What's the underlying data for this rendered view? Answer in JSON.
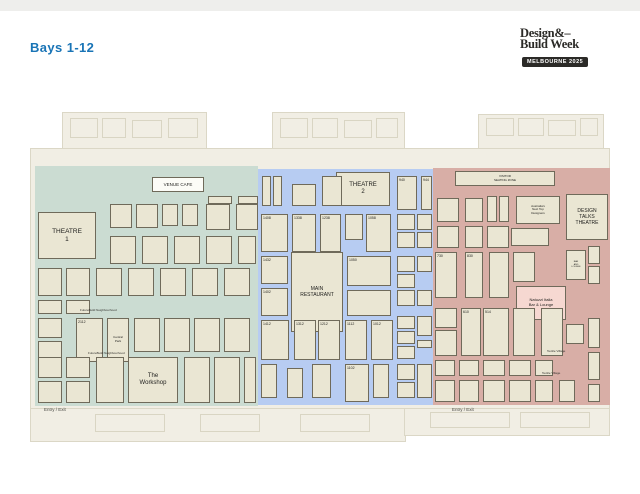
{
  "page": {
    "title": "Bays 1-12"
  },
  "logo": {
    "line1": "Design&–",
    "line2": "Build Week",
    "badge": "MELBOURNE 2025"
  },
  "palette": {
    "accent_blue": "#1974b6",
    "badge_black": "#2b2a27",
    "hall_beige": "#f1eee4",
    "booth_fill": "#eae6d3",
    "booth_border": "#6f6a5a",
    "zone_green": "#cbdcd2",
    "zone_blue": "#b7ccf2",
    "zone_pink": "#d8aea6",
    "highlight_pink": "#f6d8d1"
  },
  "map": {
    "entries": [
      {
        "x": 44,
        "y": 407,
        "label": "Entry / Exit"
      },
      {
        "x": 452,
        "y": 407,
        "label": "Entry / Exit"
      }
    ],
    "zones": [
      {
        "id": "green",
        "color": "#cbdcd2",
        "x": 35,
        "y": 166,
        "w": 223,
        "h": 240,
        "labels": [
          {
            "x": 80,
            "y": 308,
            "text": "FutureBuild Neighbourhood"
          },
          {
            "x": 88,
            "y": 351,
            "text": "FutureBuild Neighbourhood"
          }
        ],
        "booths": [
          {
            "x": 152,
            "y": 177,
            "w": 52,
            "h": 15,
            "label": "VENUE CAFE",
            "type": "banner",
            "fs": 4.5,
            "name": "venue-cafe"
          },
          {
            "x": 38,
            "y": 212,
            "w": 58,
            "h": 47,
            "label": "THEATRE\n1",
            "type": "feature",
            "fs": 6.5,
            "name": "theatre-1"
          },
          {
            "x": 208,
            "y": 196,
            "w": 24,
            "h": 8
          },
          {
            "x": 238,
            "y": 196,
            "w": 20,
            "h": 8
          },
          {
            "x": 110,
            "y": 204,
            "w": 22,
            "h": 24
          },
          {
            "x": 136,
            "y": 204,
            "w": 22,
            "h": 24
          },
          {
            "x": 162,
            "y": 204,
            "w": 16,
            "h": 22
          },
          {
            "x": 182,
            "y": 204,
            "w": 16,
            "h": 22
          },
          {
            "x": 206,
            "y": 204,
            "w": 24,
            "h": 26
          },
          {
            "x": 236,
            "y": 204,
            "w": 22,
            "h": 26
          },
          {
            "x": 110,
            "y": 236,
            "w": 26,
            "h": 28
          },
          {
            "x": 142,
            "y": 236,
            "w": 26,
            "h": 28
          },
          {
            "x": 174,
            "y": 236,
            "w": 26,
            "h": 28
          },
          {
            "x": 206,
            "y": 236,
            "w": 26,
            "h": 28
          },
          {
            "x": 238,
            "y": 236,
            "w": 18,
            "h": 28
          },
          {
            "x": 38,
            "y": 268,
            "w": 24,
            "h": 28
          },
          {
            "x": 66,
            "y": 268,
            "w": 24,
            "h": 28
          },
          {
            "x": 96,
            "y": 268,
            "w": 26,
            "h": 28
          },
          {
            "x": 128,
            "y": 268,
            "w": 26,
            "h": 28
          },
          {
            "x": 160,
            "y": 268,
            "w": 26,
            "h": 28
          },
          {
            "x": 192,
            "y": 268,
            "w": 26,
            "h": 28
          },
          {
            "x": 224,
            "y": 268,
            "w": 26,
            "h": 28
          },
          {
            "x": 38,
            "y": 300,
            "w": 24,
            "h": 14
          },
          {
            "x": 66,
            "y": 300,
            "w": 24,
            "h": 14
          },
          {
            "x": 76,
            "y": 318,
            "w": 27,
            "h": 44,
            "label": "2112",
            "name": "booth-2112"
          },
          {
            "x": 107,
            "y": 318,
            "w": 22,
            "h": 44,
            "label": "Central\nPark",
            "fs": 3,
            "name": "booth-central-park"
          },
          {
            "x": 38,
            "y": 318,
            "w": 24,
            "h": 20
          },
          {
            "x": 38,
            "y": 341,
            "w": 24,
            "h": 21
          },
          {
            "x": 134,
            "y": 318,
            "w": 26,
            "h": 34
          },
          {
            "x": 164,
            "y": 318,
            "w": 26,
            "h": 34
          },
          {
            "x": 194,
            "y": 318,
            "w": 26,
            "h": 34
          },
          {
            "x": 224,
            "y": 318,
            "w": 26,
            "h": 34
          },
          {
            "x": 128,
            "y": 357,
            "w": 50,
            "h": 46,
            "label": "The\nWorkshop",
            "type": "feature",
            "fs": 6,
            "name": "the-workshop"
          },
          {
            "x": 38,
            "y": 357,
            "w": 24,
            "h": 21
          },
          {
            "x": 38,
            "y": 381,
            "w": 24,
            "h": 22
          },
          {
            "x": 66,
            "y": 357,
            "w": 24,
            "h": 21
          },
          {
            "x": 66,
            "y": 381,
            "w": 24,
            "h": 22
          },
          {
            "x": 96,
            "y": 357,
            "w": 28,
            "h": 46
          },
          {
            "x": 184,
            "y": 357,
            "w": 26,
            "h": 46
          },
          {
            "x": 214,
            "y": 357,
            "w": 26,
            "h": 46
          },
          {
            "x": 244,
            "y": 357,
            "w": 12,
            "h": 46
          }
        ]
      },
      {
        "id": "blue",
        "color": "#b7ccf2",
        "x": 258,
        "y": 169,
        "w": 175,
        "h": 236,
        "labels": [],
        "booths": [
          {
            "x": 336,
            "y": 172,
            "w": 54,
            "h": 34,
            "label": "THEATRE\n2",
            "type": "feature",
            "fs": 6,
            "name": "theatre-2"
          },
          {
            "x": 291,
            "y": 252,
            "w": 52,
            "h": 80,
            "label": "MAIN\nRESTAURANT",
            "type": "feature",
            "fs": 5,
            "name": "main-restaurant"
          },
          {
            "x": 262,
            "y": 176,
            "w": 9,
            "h": 30
          },
          {
            "x": 273,
            "y": 176,
            "w": 9,
            "h": 30
          },
          {
            "x": 292,
            "y": 184,
            "w": 24,
            "h": 22
          },
          {
            "x": 322,
            "y": 176,
            "w": 20,
            "h": 30
          },
          {
            "x": 397,
            "y": 176,
            "w": 20,
            "h": 34,
            "label": "940",
            "name": "booth-940"
          },
          {
            "x": 421,
            "y": 176,
            "w": 11,
            "h": 34,
            "label": "944",
            "name": "booth-944"
          },
          {
            "x": 261,
            "y": 214,
            "w": 27,
            "h": 38,
            "label": "1408",
            "name": "booth-1408"
          },
          {
            "x": 292,
            "y": 214,
            "w": 24,
            "h": 38,
            "label": "1338",
            "name": "booth-1338"
          },
          {
            "x": 320,
            "y": 214,
            "w": 21,
            "h": 38,
            "label": "1238",
            "name": "booth-1238"
          },
          {
            "x": 345,
            "y": 214,
            "w": 18,
            "h": 26
          },
          {
            "x": 366,
            "y": 214,
            "w": 25,
            "h": 38,
            "label": "1058",
            "name": "booth-1058"
          },
          {
            "x": 397,
            "y": 214,
            "w": 18,
            "h": 16
          },
          {
            "x": 417,
            "y": 214,
            "w": 15,
            "h": 16
          },
          {
            "x": 397,
            "y": 232,
            "w": 18,
            "h": 16
          },
          {
            "x": 417,
            "y": 232,
            "w": 15,
            "h": 16
          },
          {
            "x": 261,
            "y": 256,
            "w": 27,
            "h": 28,
            "label": "1432",
            "name": "booth-1432"
          },
          {
            "x": 347,
            "y": 256,
            "w": 44,
            "h": 30,
            "label": "1050",
            "name": "booth-1050"
          },
          {
            "x": 397,
            "y": 256,
            "w": 18,
            "h": 16
          },
          {
            "x": 417,
            "y": 256,
            "w": 15,
            "h": 16
          },
          {
            "x": 397,
            "y": 274,
            "w": 18,
            "h": 14
          },
          {
            "x": 261,
            "y": 288,
            "w": 27,
            "h": 28,
            "label": "1402",
            "name": "booth-1402"
          },
          {
            "x": 347,
            "y": 290,
            "w": 44,
            "h": 26
          },
          {
            "x": 397,
            "y": 290,
            "w": 18,
            "h": 16
          },
          {
            "x": 417,
            "y": 290,
            "w": 15,
            "h": 16
          },
          {
            "x": 261,
            "y": 320,
            "w": 28,
            "h": 40,
            "label": "1412",
            "name": "booth-1412"
          },
          {
            "x": 294,
            "y": 320,
            "w": 22,
            "h": 40,
            "label": "1312",
            "name": "booth-1312"
          },
          {
            "x": 318,
            "y": 320,
            "w": 22,
            "h": 40,
            "label": "1212",
            "name": "booth-1212"
          },
          {
            "x": 345,
            "y": 320,
            "w": 22,
            "h": 40,
            "label": "1112",
            "name": "booth-1112"
          },
          {
            "x": 371,
            "y": 320,
            "w": 22,
            "h": 40,
            "label": "1012",
            "name": "booth-1012"
          },
          {
            "x": 397,
            "y": 316,
            "w": 18,
            "h": 13
          },
          {
            "x": 397,
            "y": 331,
            "w": 18,
            "h": 13
          },
          {
            "x": 397,
            "y": 346,
            "w": 18,
            "h": 13
          },
          {
            "x": 417,
            "y": 316,
            "w": 15,
            "h": 20
          },
          {
            "x": 417,
            "y": 340,
            "w": 15,
            "h": 8
          },
          {
            "x": 261,
            "y": 364,
            "w": 16,
            "h": 34
          },
          {
            "x": 287,
            "y": 368,
            "w": 16,
            "h": 30
          },
          {
            "x": 312,
            "y": 364,
            "w": 19,
            "h": 34
          },
          {
            "x": 345,
            "y": 364,
            "w": 24,
            "h": 38,
            "label": "1102",
            "name": "booth-1102"
          },
          {
            "x": 373,
            "y": 364,
            "w": 16,
            "h": 34
          },
          {
            "x": 397,
            "y": 364,
            "w": 18,
            "h": 16
          },
          {
            "x": 397,
            "y": 382,
            "w": 18,
            "h": 16
          },
          {
            "x": 417,
            "y": 364,
            "w": 15,
            "h": 34
          }
        ]
      },
      {
        "id": "pink",
        "color": "#d8aea6",
        "x": 433,
        "y": 168,
        "w": 177,
        "h": 237,
        "labels": [
          {
            "x": 547,
            "y": 349,
            "text": "Textile Village"
          },
          {
            "x": 542,
            "y": 371,
            "text": "Textile Village"
          }
        ],
        "booths": [
          {
            "x": 455,
            "y": 171,
            "w": 100,
            "h": 15,
            "label": "VISITOR\nSEATING ZONE",
            "fs": 3,
            "name": "visitor-seating-zone"
          },
          {
            "x": 516,
            "y": 196,
            "w": 44,
            "h": 28,
            "label": "Australia's\nNext Top\nDesigners",
            "fs": 3,
            "name": "booth-australias-next-top-designers"
          },
          {
            "x": 566,
            "y": 194,
            "w": 42,
            "h": 46,
            "label": "DESIGN\nTALKS\nTHEATRE",
            "type": "feature",
            "fs": 5,
            "name": "design-talks-theatre"
          },
          {
            "x": 437,
            "y": 198,
            "w": 22,
            "h": 24
          },
          {
            "x": 465,
            "y": 198,
            "w": 18,
            "h": 24
          },
          {
            "x": 487,
            "y": 196,
            "w": 10,
            "h": 26
          },
          {
            "x": 499,
            "y": 196,
            "w": 10,
            "h": 26
          },
          {
            "x": 437,
            "y": 226,
            "w": 22,
            "h": 22
          },
          {
            "x": 465,
            "y": 226,
            "w": 18,
            "h": 22
          },
          {
            "x": 487,
            "y": 226,
            "w": 22,
            "h": 22
          },
          {
            "x": 511,
            "y": 228,
            "w": 38,
            "h": 18
          },
          {
            "x": 435,
            "y": 252,
            "w": 22,
            "h": 46,
            "label": "730",
            "name": "booth-730"
          },
          {
            "x": 465,
            "y": 252,
            "w": 18,
            "h": 46,
            "label": "830",
            "name": "booth-830"
          },
          {
            "x": 489,
            "y": 252,
            "w": 20,
            "h": 46
          },
          {
            "x": 513,
            "y": 252,
            "w": 22,
            "h": 30
          },
          {
            "x": 566,
            "y": 250,
            "w": 20,
            "h": 30,
            "label": "BAR\nAND\nLOUNGE",
            "fs": 2.2,
            "name": "booth-bar-and-lounge"
          },
          {
            "x": 588,
            "y": 246,
            "w": 12,
            "h": 18
          },
          {
            "x": 588,
            "y": 266,
            "w": 12,
            "h": 18
          },
          {
            "x": 516,
            "y": 286,
            "w": 50,
            "h": 34,
            "label": "Natuzzi Italia\nBar & Lounge",
            "type": "highlight",
            "fs": 4,
            "name": "natuzzi-italia-bar-lounge"
          },
          {
            "x": 435,
            "y": 308,
            "w": 22,
            "h": 20
          },
          {
            "x": 435,
            "y": 330,
            "w": 22,
            "h": 26
          },
          {
            "x": 461,
            "y": 308,
            "w": 20,
            "h": 48,
            "label": "610",
            "name": "booth-610"
          },
          {
            "x": 483,
            "y": 308,
            "w": 26,
            "h": 48,
            "label": "514",
            "name": "booth-514"
          },
          {
            "x": 513,
            "y": 308,
            "w": 22,
            "h": 48
          },
          {
            "x": 541,
            "y": 308,
            "w": 22,
            "h": 48
          },
          {
            "x": 588,
            "y": 318,
            "w": 12,
            "h": 30
          },
          {
            "x": 566,
            "y": 324,
            "w": 18,
            "h": 20
          },
          {
            "x": 435,
            "y": 360,
            "w": 20,
            "h": 16
          },
          {
            "x": 459,
            "y": 360,
            "w": 20,
            "h": 16
          },
          {
            "x": 483,
            "y": 360,
            "w": 22,
            "h": 16
          },
          {
            "x": 509,
            "y": 360,
            "w": 22,
            "h": 16
          },
          {
            "x": 535,
            "y": 360,
            "w": 18,
            "h": 16
          },
          {
            "x": 435,
            "y": 380,
            "w": 20,
            "h": 22
          },
          {
            "x": 459,
            "y": 380,
            "w": 20,
            "h": 22
          },
          {
            "x": 483,
            "y": 380,
            "w": 22,
            "h": 22
          },
          {
            "x": 509,
            "y": 380,
            "w": 22,
            "h": 22
          },
          {
            "x": 535,
            "y": 380,
            "w": 18,
            "h": 22
          },
          {
            "x": 559,
            "y": 380,
            "w": 16,
            "h": 22
          },
          {
            "x": 588,
            "y": 352,
            "w": 12,
            "h": 28
          },
          {
            "x": 588,
            "y": 384,
            "w": 12,
            "h": 18
          }
        ]
      }
    ]
  }
}
